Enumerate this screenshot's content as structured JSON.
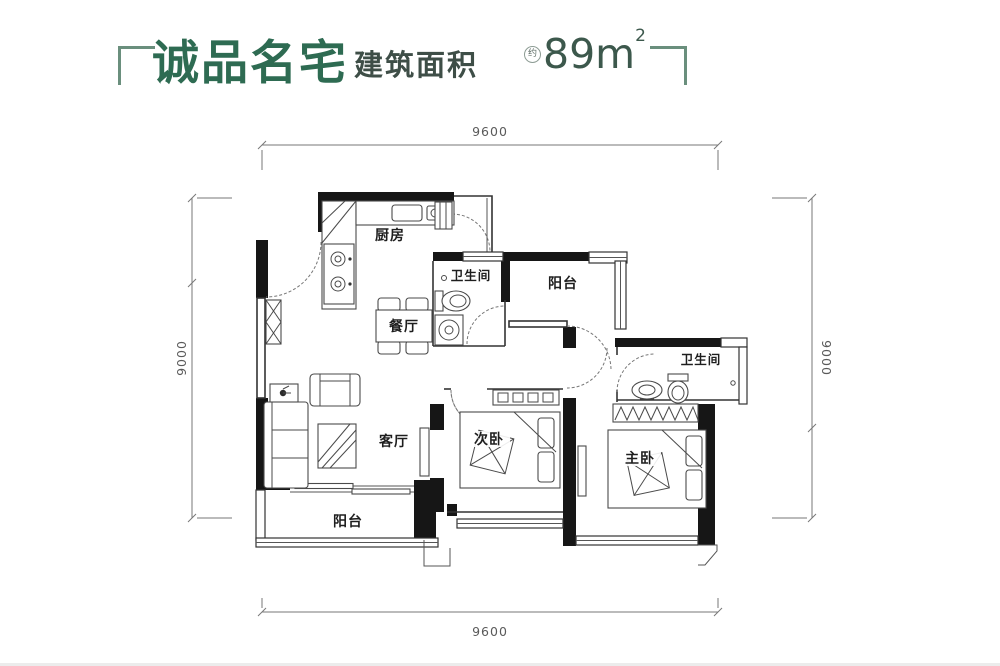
{
  "header": {
    "title": "诚品名宅",
    "area_label": "建筑面积",
    "approx": "约",
    "area_value": "89m",
    "area_exponent": "2",
    "accent_color": "#2e6b52"
  },
  "dimensions": {
    "top": "9600",
    "bottom": "9600",
    "left": "9000",
    "right": "9000"
  },
  "rooms": {
    "kitchen": "厨房",
    "bath1": "卫生间",
    "balcony_top": "阳台",
    "dining": "餐厅",
    "bath2": "卫生间",
    "living": "客厅",
    "bedroom2": "次卧",
    "master": "主卧",
    "balcony_bottom": "阳台"
  }
}
